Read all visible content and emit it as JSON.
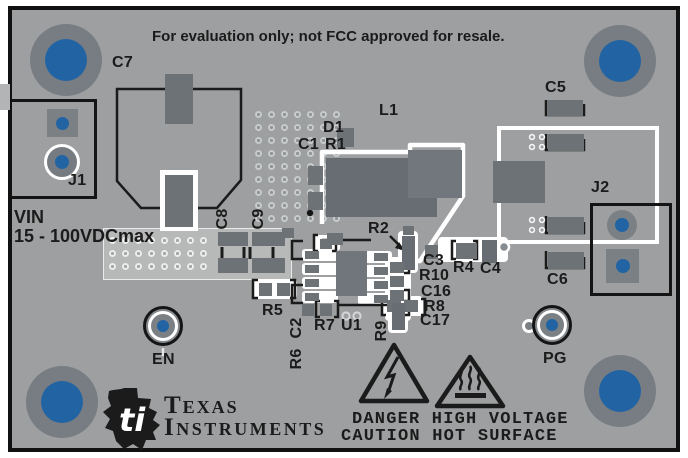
{
  "board": {
    "notice": "For evaluation only; not FCC approved for resale.",
    "input": {
      "label": "VIN",
      "rating": "15 - 100VDCmax"
    },
    "warning": {
      "line1": "DANGER HIGH VOLTAGE",
      "line2": "CAUTION HOT SURFACE"
    },
    "brand": {
      "word1": "Texas",
      "word2": "Instruments",
      "bug": "ti"
    },
    "colors": {
      "frame": "#111111",
      "board": "#9d9fa0",
      "silk_black": "#1b1b1b",
      "silk_white": "#ffffff",
      "pad_dark": "#6d7277",
      "pad_mid": "#7b8085",
      "drill_blue": "#2264a3",
      "light_zone": "#b7b8b8"
    }
  },
  "designators": {
    "c1": "C1",
    "c2": "C2",
    "c3": "C3",
    "c4": "C4",
    "c5": "C5",
    "c6": "C6",
    "c7": "C7",
    "c8": "C8",
    "c9": "C9",
    "c16": "C16",
    "c17": "C17",
    "r1": "R1",
    "r2": "R2",
    "r4": "R4",
    "r5": "R5",
    "r6": "R6",
    "r7": "R7",
    "r8": "R8",
    "r9": "R9",
    "r10": "R10",
    "d1": "D1",
    "l1": "L1",
    "u1": "U1"
  },
  "connectors": {
    "j1": "J1",
    "j2": "J2"
  },
  "test_points": {
    "en": "EN",
    "pg": "PG"
  }
}
